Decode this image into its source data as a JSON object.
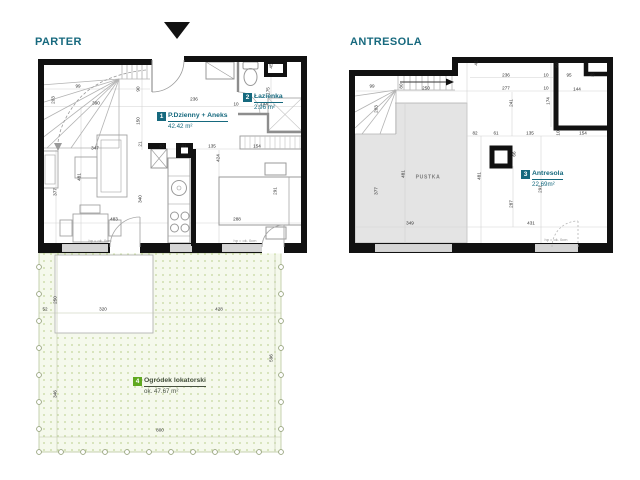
{
  "colors": {
    "accent_teal": "#16697E",
    "badge_green": "#5FA81F",
    "garden_text": "#475240",
    "wall": "#111111",
    "void_fill": "#E4E4E4",
    "garden_fill": "#F5F9EC",
    "garden_dot": "#C2D69B"
  },
  "titles": {
    "left": "PARTER",
    "right": "ANTRESOLA"
  },
  "rooms": [
    {
      "badge": "1",
      "name": "P.Dzienny + Aneks",
      "area": "42.42 m²",
      "badge_color": "#16697E",
      "text_color": "#16697E",
      "x": 157,
      "y": 112
    },
    {
      "badge": "2",
      "name": "Łazienka",
      "area": "2.96 m²",
      "badge_color": "#16697E",
      "text_color": "#16697E",
      "x": 243,
      "y": 93
    },
    {
      "badge": "3",
      "name": "Antresola",
      "area": "22.69m²",
      "badge_color": "#16697E",
      "text_color": "#16697E",
      "x": 521,
      "y": 170
    },
    {
      "badge": "4",
      "name": "Ogródek lokatorski",
      "area": "ok. 47.67 m²",
      "badge_color": "#5FA81F",
      "text_color": "#475240",
      "x": 133,
      "y": 377
    }
  ],
  "void_label": {
    "text": "PUSTKA",
    "x": 428,
    "y": 178
  },
  "annotations": [
    {
      "text": "hp = ok. 0cm",
      "x": 100,
      "y": 241
    },
    {
      "text": "hp = ok. 0cm",
      "x": 245,
      "y": 241
    },
    {
      "text": "hp = ok. 0cm",
      "x": 556,
      "y": 240
    }
  ],
  "dimensions": [
    {
      "t": "99",
      "x": 78,
      "y": 87
    },
    {
      "t": "203",
      "x": 54,
      "y": 100,
      "v": 1
    },
    {
      "t": "390",
      "x": 96,
      "y": 104
    },
    {
      "t": "90",
      "x": 139,
      "y": 89,
      "v": 1
    },
    {
      "t": "150",
      "x": 139,
      "y": 121,
      "v": 1
    },
    {
      "t": "21",
      "x": 141,
      "y": 144,
      "v": 1
    },
    {
      "t": "236",
      "x": 194,
      "y": 100
    },
    {
      "t": "10",
      "x": 236,
      "y": 105
    },
    {
      "t": "144",
      "x": 264,
      "y": 105
    },
    {
      "t": "175",
      "x": 269,
      "y": 91,
      "v": 1
    },
    {
      "t": "45",
      "x": 272,
      "y": 66,
      "v": 1
    },
    {
      "t": "83",
      "x": 162,
      "y": 147
    },
    {
      "t": "61",
      "x": 184,
      "y": 147
    },
    {
      "t": "135",
      "x": 212,
      "y": 147
    },
    {
      "t": "154",
      "x": 257,
      "y": 147
    },
    {
      "t": "424",
      "x": 219,
      "y": 158,
      "v": 1
    },
    {
      "t": "347",
      "x": 95,
      "y": 149
    },
    {
      "t": "481",
      "x": 80,
      "y": 177,
      "v": 1
    },
    {
      "t": "377",
      "x": 56,
      "y": 192,
      "v": 1
    },
    {
      "t": "340",
      "x": 141,
      "y": 199,
      "v": 1
    },
    {
      "t": "483",
      "x": 114,
      "y": 220
    },
    {
      "t": "288",
      "x": 237,
      "y": 220
    },
    {
      "t": "291",
      "x": 276,
      "y": 191,
      "v": 1
    },
    {
      "t": "52",
      "x": 45,
      "y": 310
    },
    {
      "t": "250",
      "x": 56,
      "y": 300,
      "v": 1
    },
    {
      "t": "320",
      "x": 103,
      "y": 310
    },
    {
      "t": "428",
      "x": 219,
      "y": 310
    },
    {
      "t": "596",
      "x": 272,
      "y": 358,
      "v": 1
    },
    {
      "t": "346",
      "x": 56,
      "y": 394,
      "v": 1
    },
    {
      "t": "800",
      "x": 160,
      "y": 431
    },
    {
      "t": "99",
      "x": 372,
      "y": 87
    },
    {
      "t": "80",
      "x": 402,
      "y": 86,
      "v": 1
    },
    {
      "t": "250",
      "x": 426,
      "y": 89
    },
    {
      "t": "203",
      "x": 377,
      "y": 109,
      "v": 1
    },
    {
      "t": "42",
      "x": 477,
      "y": 63,
      "v": 1
    },
    {
      "t": "236",
      "x": 506,
      "y": 76
    },
    {
      "t": "10",
      "x": 546,
      "y": 76
    },
    {
      "t": "95",
      "x": 569,
      "y": 76
    },
    {
      "t": "49",
      "x": 592,
      "y": 76
    },
    {
      "t": "277",
      "x": 506,
      "y": 89
    },
    {
      "t": "10",
      "x": 546,
      "y": 89
    },
    {
      "t": "144",
      "x": 577,
      "y": 90
    },
    {
      "t": "50",
      "x": 558,
      "y": 65,
      "v": 1
    },
    {
      "t": "174",
      "x": 549,
      "y": 101,
      "v": 1
    },
    {
      "t": "241",
      "x": 512,
      "y": 103,
      "v": 1
    },
    {
      "t": "82",
      "x": 475,
      "y": 134
    },
    {
      "t": "61",
      "x": 496,
      "y": 134
    },
    {
      "t": "135",
      "x": 530,
      "y": 134
    },
    {
      "t": "10",
      "x": 559,
      "y": 133,
      "v": 1
    },
    {
      "t": "154",
      "x": 583,
      "y": 134
    },
    {
      "t": "66",
      "x": 515,
      "y": 154,
      "v": 1
    },
    {
      "t": "481",
      "x": 404,
      "y": 174,
      "v": 1
    },
    {
      "t": "481",
      "x": 480,
      "y": 176,
      "v": 1
    },
    {
      "t": "377",
      "x": 377,
      "y": 191,
      "v": 1
    },
    {
      "t": "287",
      "x": 512,
      "y": 204,
      "v": 1
    },
    {
      "t": "291",
      "x": 541,
      "y": 189,
      "v": 1
    },
    {
      "t": "349",
      "x": 410,
      "y": 224
    },
    {
      "t": "431",
      "x": 531,
      "y": 224
    }
  ]
}
